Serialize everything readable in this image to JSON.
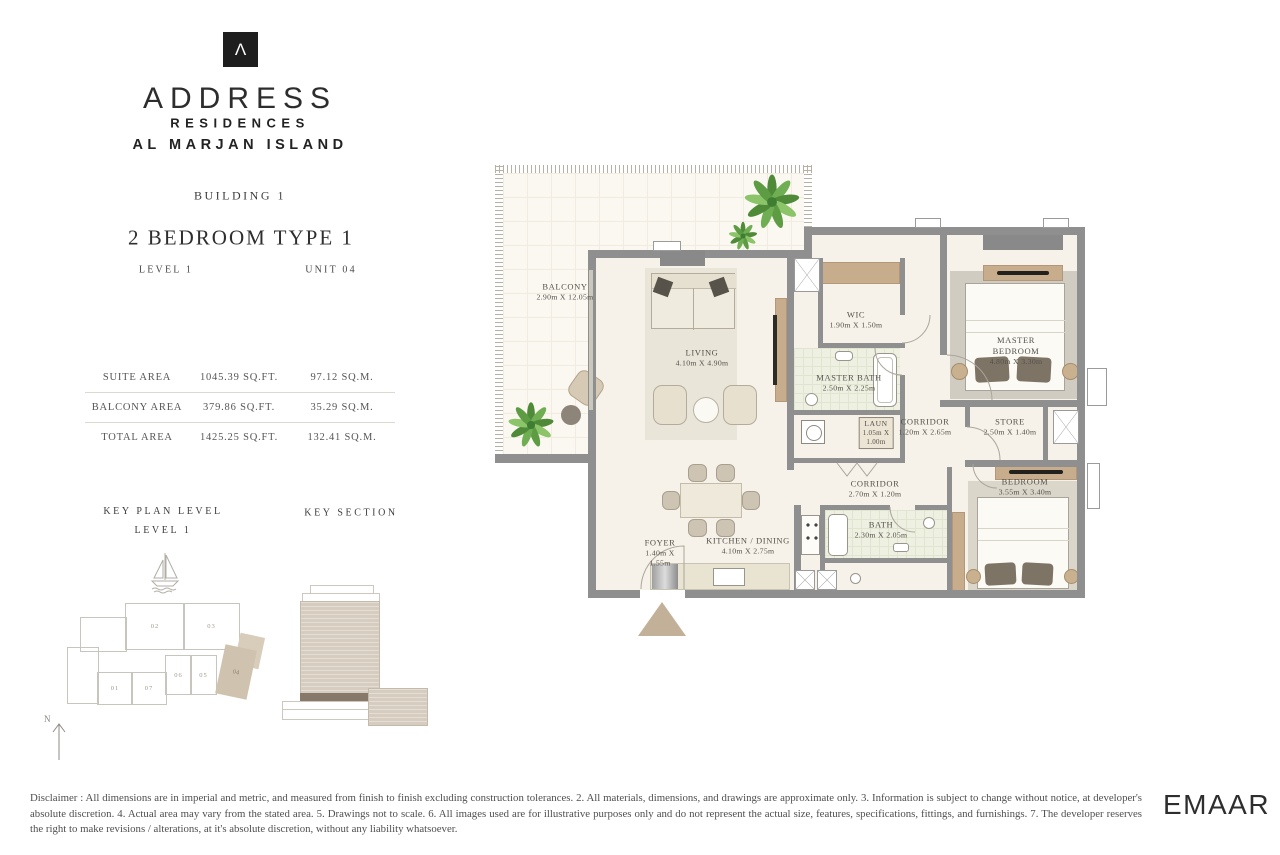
{
  "brand": {
    "logo_glyph": "Λ",
    "name": "ADDRESS",
    "line2": "RESIDENCES",
    "line3": "AL MARJAN ISLAND"
  },
  "header": {
    "building": "BUILDING 1",
    "unit_type": "2 BEDROOM TYPE 1",
    "level": "LEVEL 1",
    "unit": "UNIT 04"
  },
  "areas": {
    "rows": [
      {
        "label": "SUITE AREA",
        "sqft": "1045.39 SQ.FT.",
        "sqm": "97.12 SQ.M."
      },
      {
        "label": "BALCONY AREA",
        "sqft": "379.86 SQ.FT.",
        "sqm": "35.29 SQ.M."
      },
      {
        "label": "TOTAL AREA",
        "sqft": "1425.25 SQ.FT.",
        "sqm": "132.41 SQ.M."
      }
    ]
  },
  "key_plan": {
    "title_line1": "KEY PLAN LEVEL",
    "title_line2": "LEVEL 1",
    "units": [
      "01",
      "02",
      "03",
      "04",
      "05",
      "06",
      "07"
    ],
    "highlighted_unit": "04"
  },
  "key_section": {
    "title": "KEY SECTION"
  },
  "compass": {
    "north_label": "N"
  },
  "rooms": {
    "balcony": {
      "name": "BALCONY",
      "dims": "2.90m X 12.05m"
    },
    "living": {
      "name": "LIVING",
      "dims": "4.10m X 4.90m"
    },
    "wic": {
      "name": "WIC",
      "dims": "1.90m X 1.50m"
    },
    "master_bath": {
      "name": "MASTER BATH",
      "dims": "2.50m X 2.25m"
    },
    "laundry": {
      "name": "LAUN",
      "dims1": "1.05m X",
      "dims2": "1.00m"
    },
    "corridor_upper": {
      "name": "CORRIDOR",
      "dims": "1.20m X 2.65m"
    },
    "store": {
      "name": "STORE",
      "dims": "2.50m X 1.40m"
    },
    "master_bedroom": {
      "name": "MASTER BEDROOM",
      "dims": "4.80m X 3.30m"
    },
    "corridor_lower": {
      "name": "CORRIDOR",
      "dims": "2.70m X 1.20m"
    },
    "bath": {
      "name": "BATH",
      "dims": "2.30m X 2.05m"
    },
    "bedroom": {
      "name": "BEDROOM",
      "dims": "3.55m X 3.40m"
    },
    "foyer": {
      "name": "FOYER",
      "dims1": "1.40m X",
      "dims2": "1.55m"
    },
    "kitchen": {
      "name": "KITCHEN / DINING",
      "dims": "4.10m X 2.75m"
    }
  },
  "footer": {
    "disclaimer": "Disclaimer : All dimensions are in imperial and metric, and measured from finish to finish excluding construction tolerances. 2. All materials, dimensions, and drawings are approximate only. 3. Information is subject to change without notice, at developer's absolute discretion. 4. Actual area may vary from the stated area. 5. Drawings not to scale. 6. All images used are for illustrative purposes only and do not represent the actual size, features, specifications, fittings, and furnishings. 7. The developer reserves the right to make revisions / alterations, at it's absolute discretion, without any liability whatsoever.",
    "logo": "EMAAR"
  },
  "colors": {
    "wall": "#8f8f8f",
    "floor": "#f7f2e9",
    "accent_tan": "#c8ad8c",
    "highlight_unit": "#cfc2ae",
    "plant_green": "#5e9c43"
  }
}
